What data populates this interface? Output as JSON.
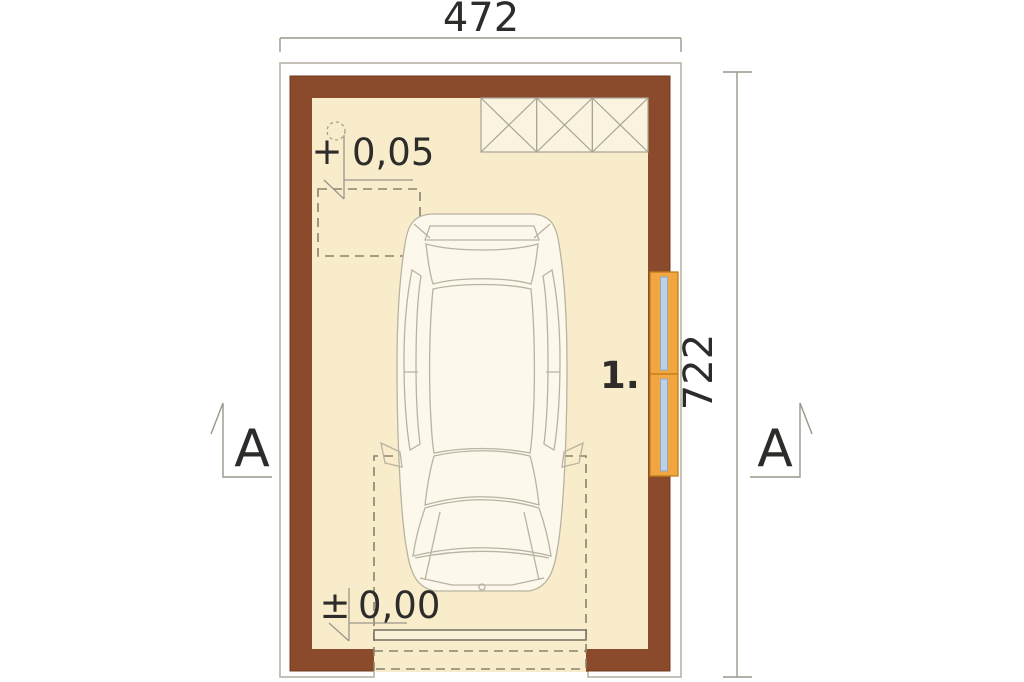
{
  "plan": {
    "dim_top": "472",
    "dim_right": "722",
    "level_upper_sign": "+",
    "level_upper_value": "0,05",
    "level_lower_sign": "±",
    "level_lower_value": "0,00",
    "room_label": "1.",
    "section_label_left": "A",
    "section_label_right": "A"
  },
  "colors": {
    "wall": "#8a4a2b",
    "wall_edge": "#70381c",
    "floor": "#f8ecca",
    "hatch_fill": "#f9f3df",
    "window_frame": "#f2a641",
    "window_frame_edge": "#c07f1a",
    "window_glass": "#bcd0e6",
    "outline": "#b3ae9f",
    "dimension_line": "#9a968a",
    "dashed_line": "#87836f",
    "text": "#2e2c2a",
    "background": "#ffffff"
  }
}
